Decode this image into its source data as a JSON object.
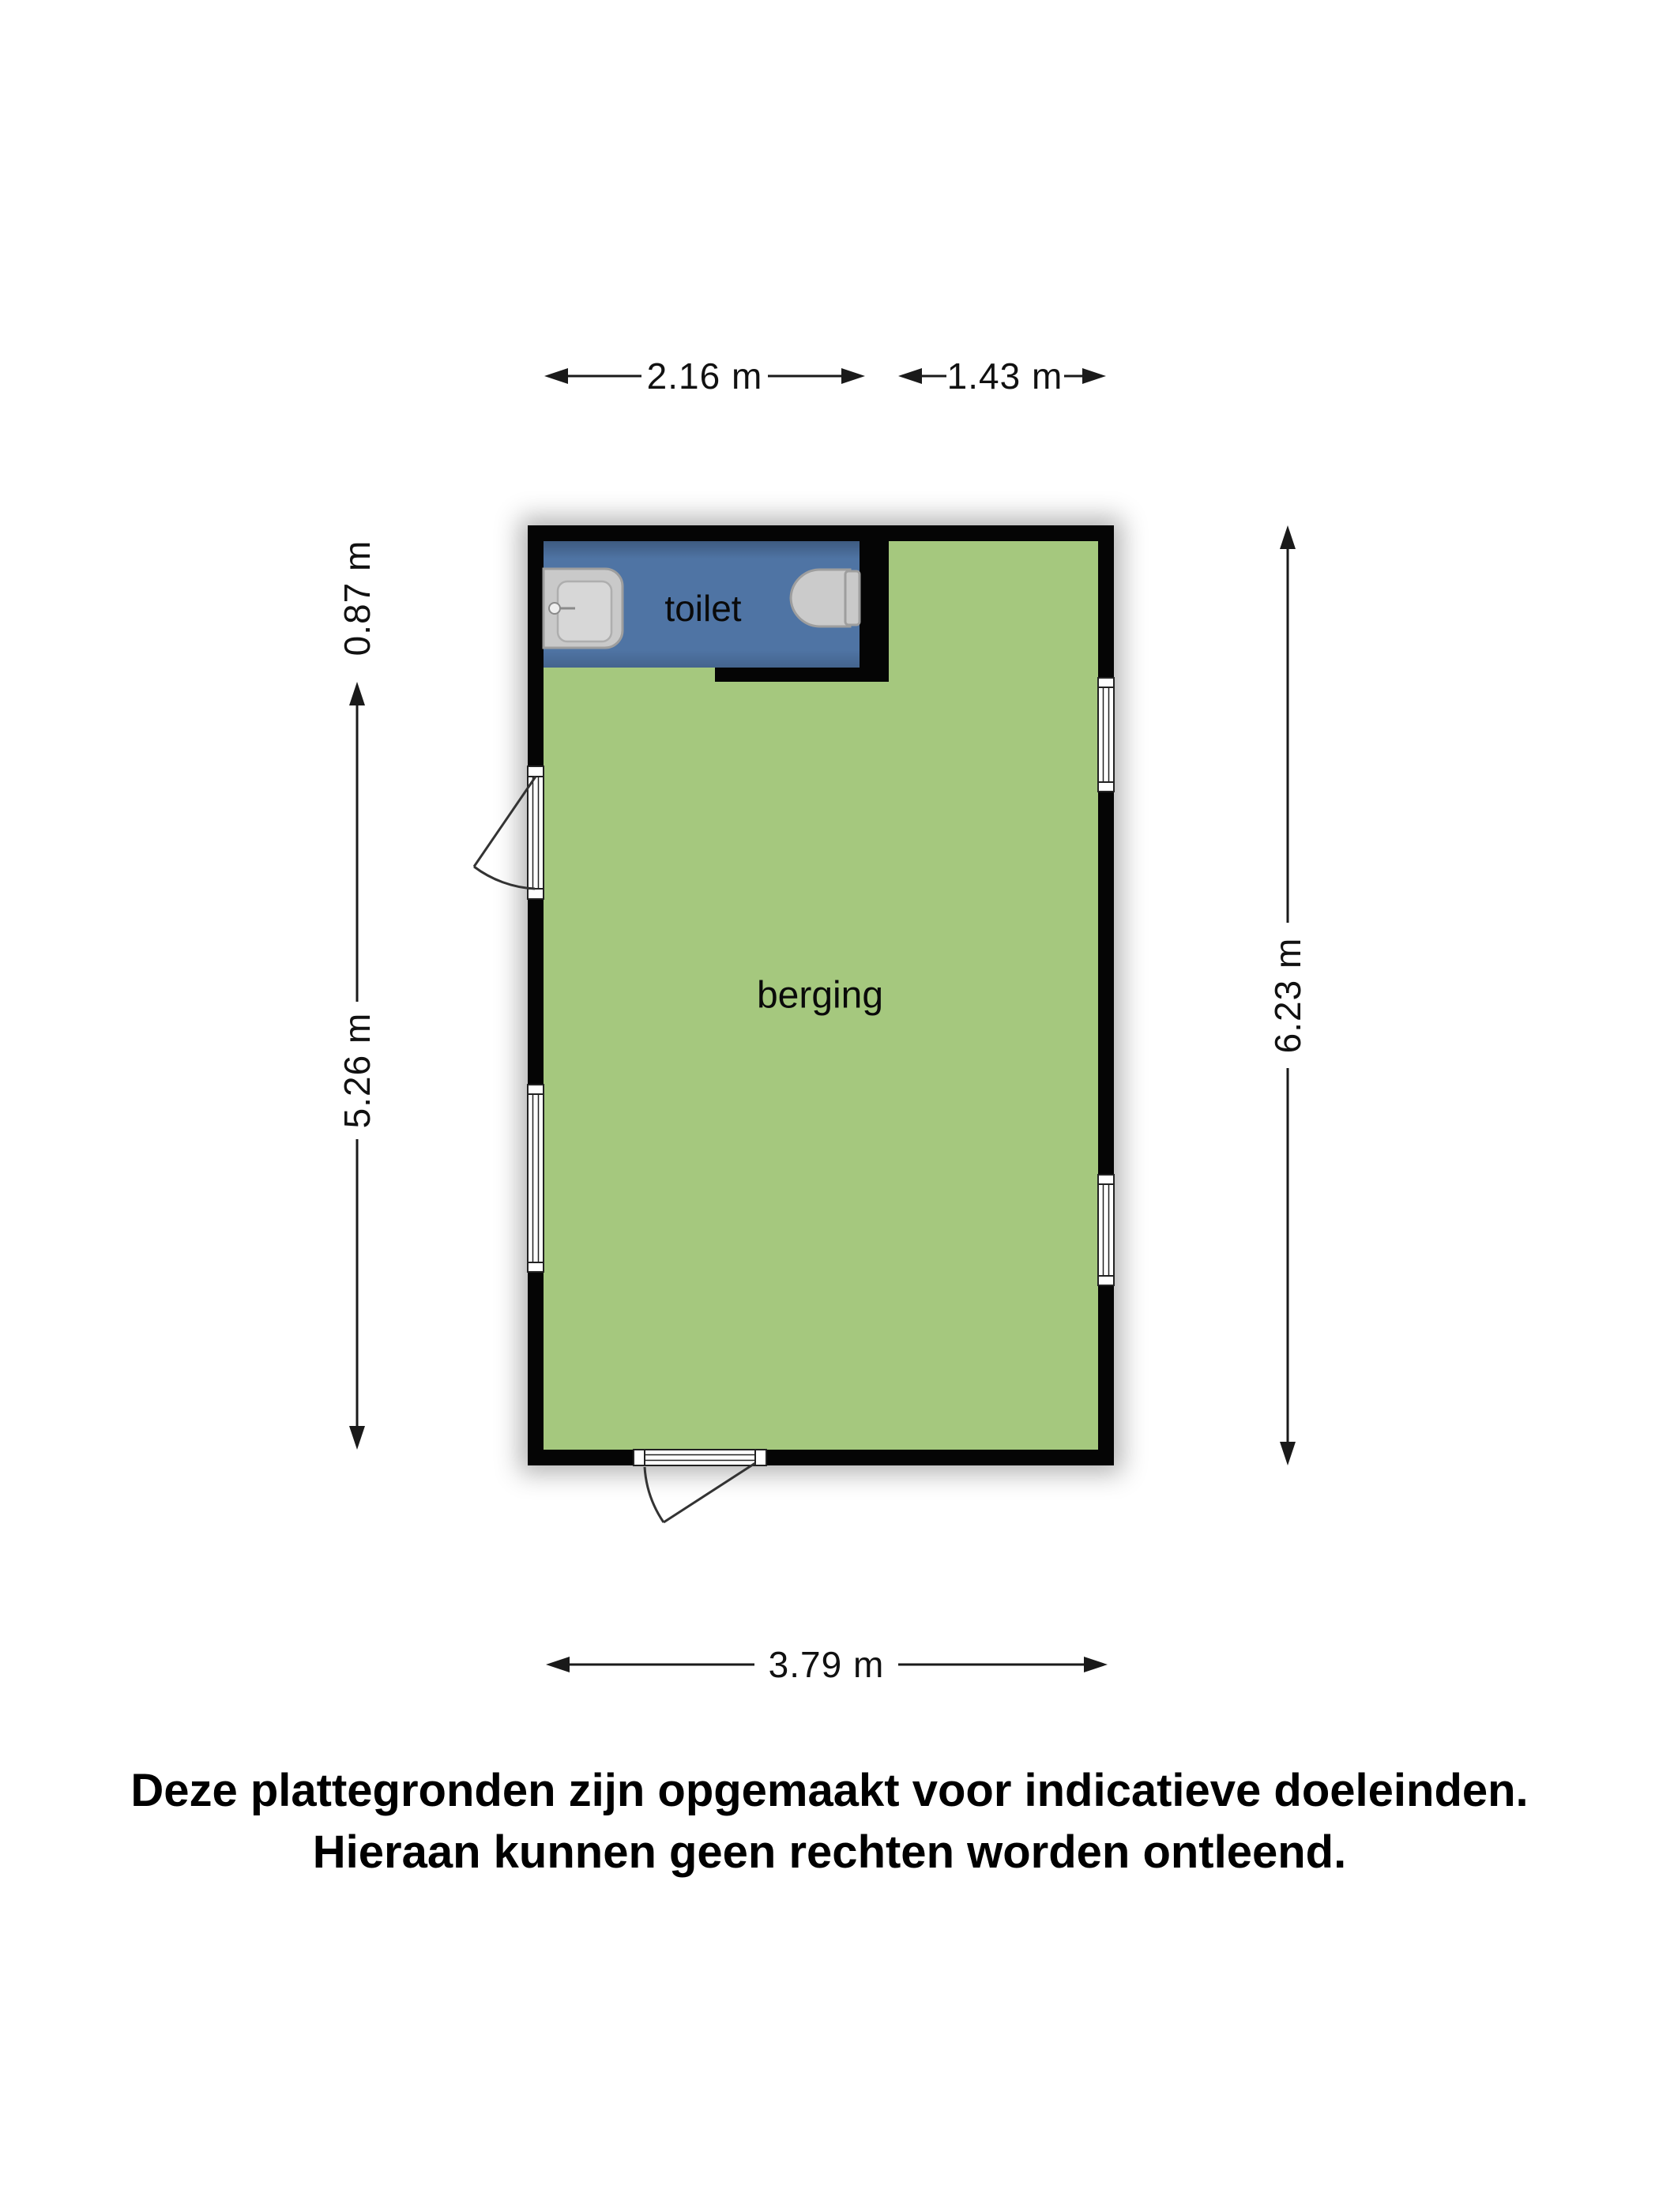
{
  "floorplan": {
    "rooms": [
      {
        "id": "toilet",
        "label": "toilet",
        "fill": "#4f74a4"
      },
      {
        "id": "berging",
        "label": "berging",
        "fill": "#a5c87e"
      }
    ],
    "colors": {
      "wall": "#050505",
      "fixture_fill": "#c9c9c9",
      "fixture_stroke": "#9e9e9e",
      "fixture_inner": "#d7d7d7",
      "dimension_lines": "#1a1a1a"
    },
    "dimensions": {
      "toilet_width": "2.16 m",
      "berging_top_width": "1.43 m",
      "toilet_height": "0.87 m",
      "berging_height": "5.26 m",
      "total_height": "6.23 m",
      "total_width": "3.79 m"
    },
    "fixtures": [
      {
        "name": "sink"
      },
      {
        "name": "toilet-bowl"
      }
    ],
    "openings": {
      "windows": 3,
      "doors": 2
    }
  },
  "disclaimer": {
    "line1": "Deze plattegronden zijn opgemaakt voor indicatieve doeleinden.",
    "line2": "Hieraan kunnen geen rechten worden ontleend."
  }
}
